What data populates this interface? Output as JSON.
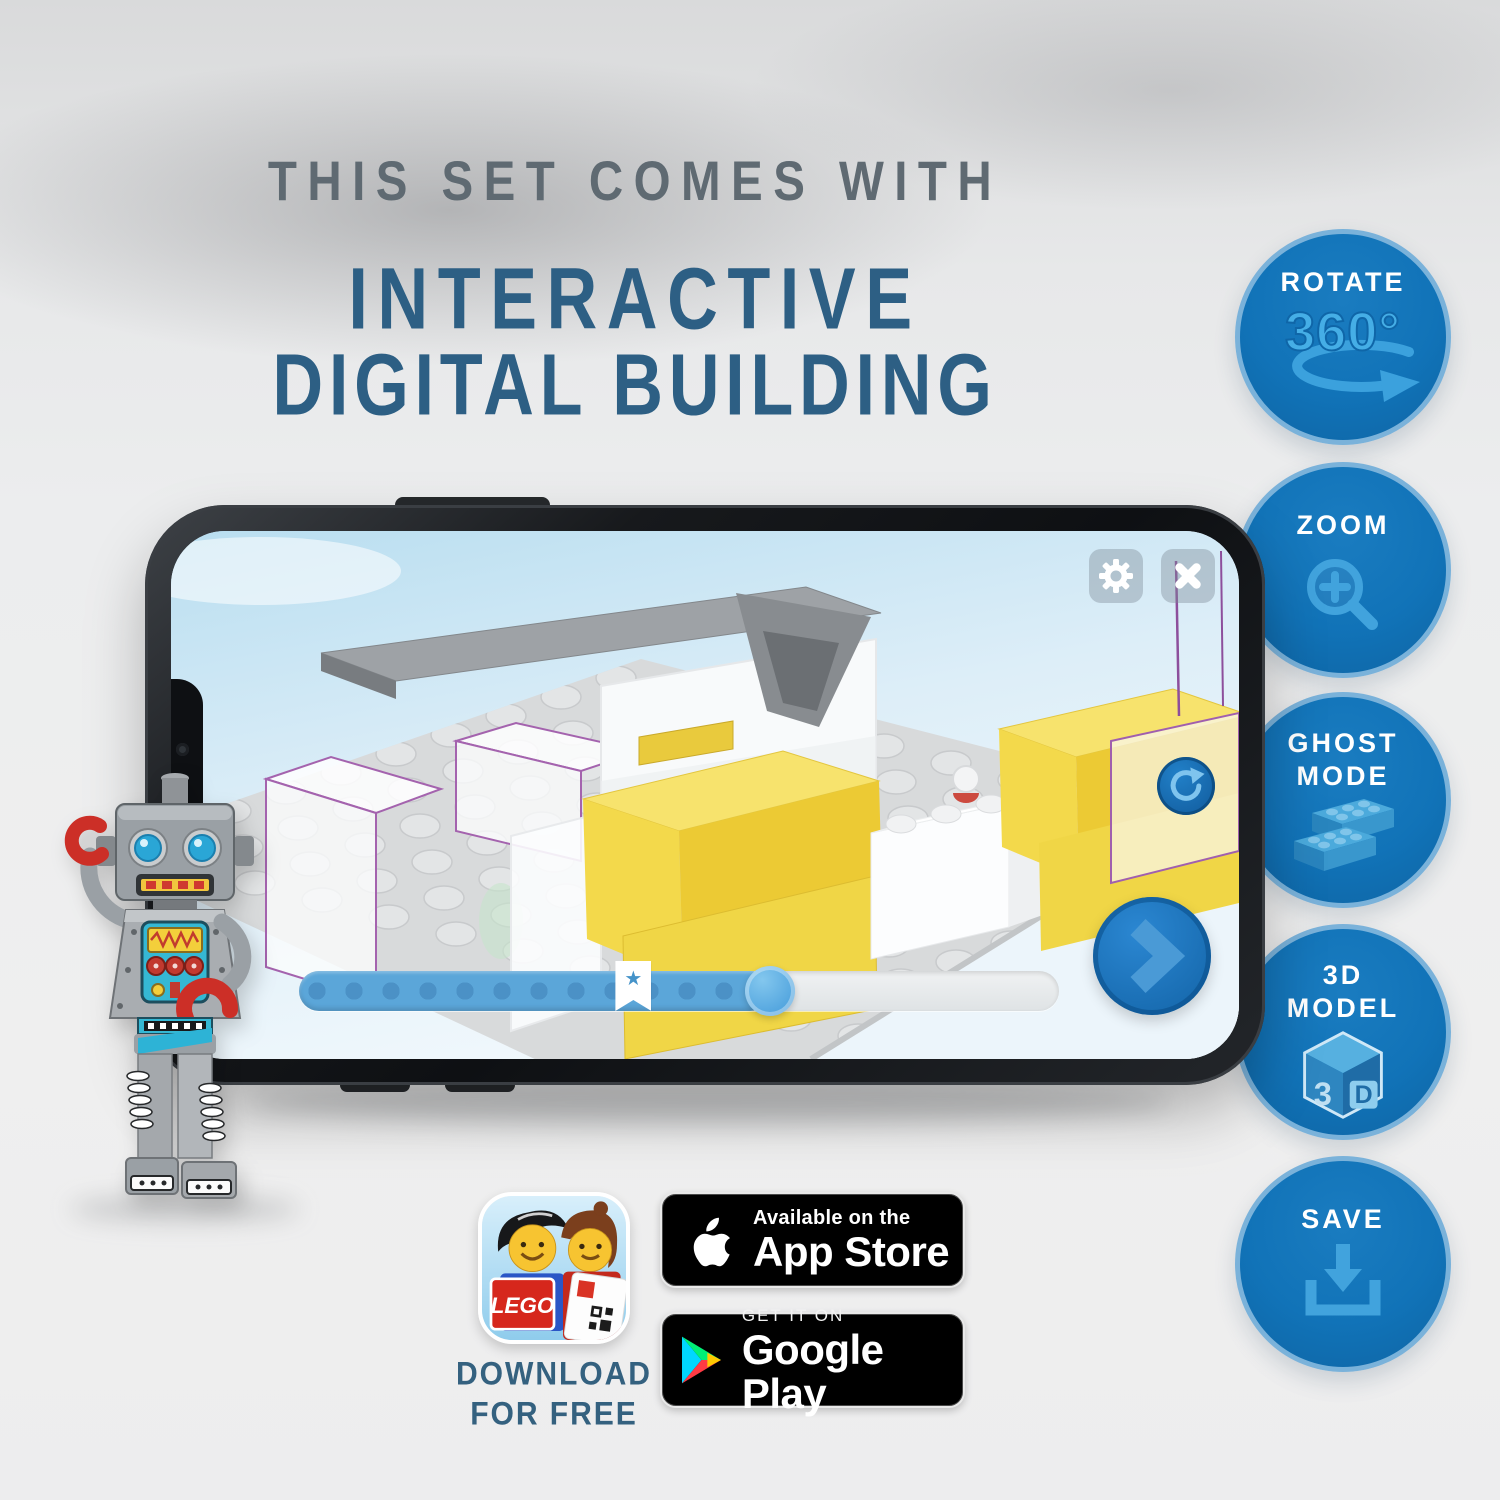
{
  "title": {
    "kicker": "THIS SET COMES WITH",
    "line1": "INTERACTIVE",
    "line2": "DIGITAL BUILDING"
  },
  "feature_badges": [
    {
      "name": "rotate",
      "line1": "ROTATE",
      "icon_text": "360°"
    },
    {
      "name": "zoom",
      "line1": "ZOOM"
    },
    {
      "name": "ghost-mode",
      "line1": "GHOST",
      "line2": "MODE"
    },
    {
      "name": "3d-model",
      "line1": "3D",
      "line2": "MODEL",
      "cube_left": "3",
      "cube_right": "D"
    },
    {
      "name": "save",
      "line1": "SAVE"
    }
  ],
  "phone_app": {
    "progress": {
      "percent_complete": 62,
      "bookmark_percent": 44
    }
  },
  "download_cta": {
    "line1": "DOWNLOAD",
    "line2": "FOR FREE"
  },
  "stores": {
    "apple_tagline": "Available on the",
    "apple_name": "App Store",
    "google_tagline": "GET IT ON",
    "google_name": "Google Play"
  },
  "lego_app_icon": {
    "logo_text": "LEGO"
  },
  "colors": {
    "badge_fill": "#1173b8",
    "badge_border": "#7ab2da",
    "badge_icon": "#41a3dd",
    "title_gray": "#5f6a72",
    "title_blue": "#2d5f84",
    "ui_blue": "#1b74bd",
    "slider_blue": "#5ba6d9",
    "brick_yellow": "#f3d94b"
  }
}
